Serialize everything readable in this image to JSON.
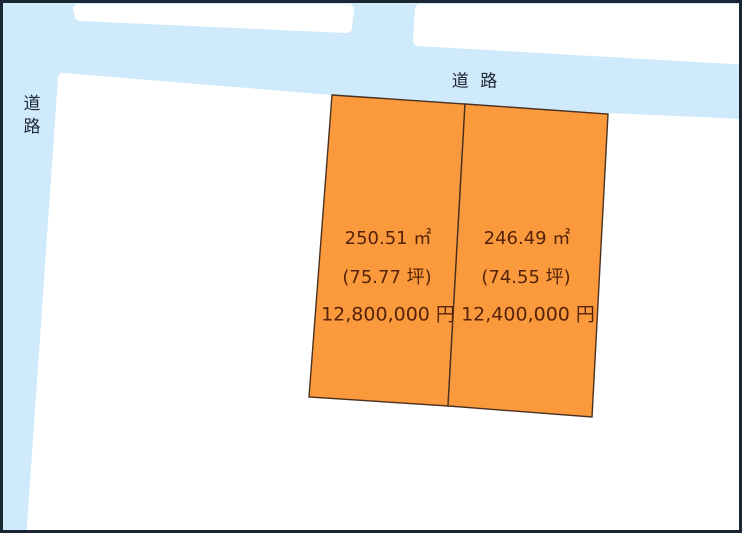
{
  "diagram": {
    "type": "land-plot-road-map",
    "colors": {
      "road_fill": "#cfeafa",
      "block_fill": "#ffffff",
      "plot_fill": "#fb9a3c",
      "plot_outline": "#4a3020",
      "outer_border": "#1a2634",
      "plot_text": "#55230a",
      "road_text": "#1e2737"
    },
    "road_labels": {
      "top": "道 路",
      "left": "道路"
    },
    "plots": [
      {
        "area_m2": "250.51 ㎡",
        "area_tsubo": "(75.77 坪)",
        "price": "12,800,000 円"
      },
      {
        "area_m2": "246.49 ㎡",
        "area_tsubo": "(74.55 坪)",
        "price": "12,400,000 円"
      }
    ]
  }
}
